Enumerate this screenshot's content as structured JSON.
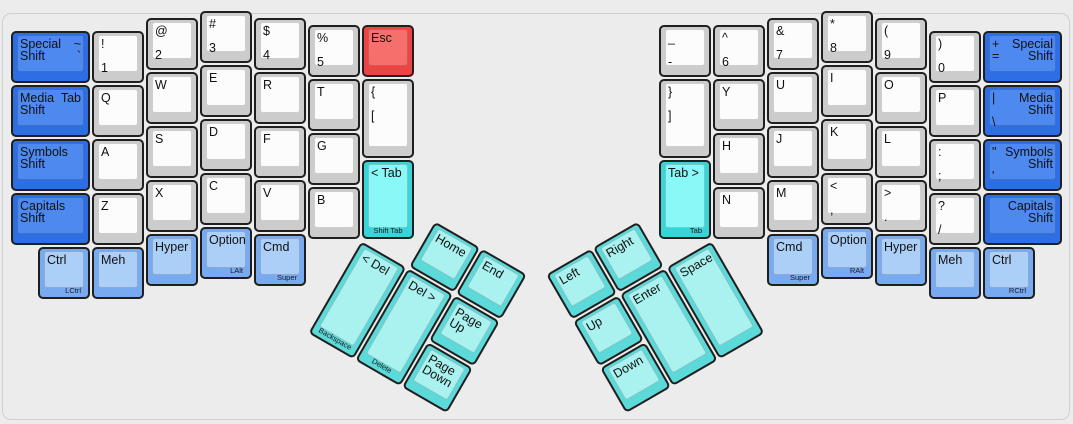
{
  "board": {
    "background": "#ececec",
    "unit_px": 54,
    "colors": {
      "gray": {
        "base": "#cccccc",
        "top": "#fcfcfc"
      },
      "blue": {
        "base": "#2d6ee4",
        "top": "#4d89ee"
      },
      "mod": {
        "base": "#78aaf2",
        "top": "#accff8"
      },
      "tab": {
        "base": "#38d4d8",
        "top": "#8bf8f8"
      },
      "thumb": {
        "base": "#5cd9d9",
        "top": "#a9f2f0"
      },
      "red": {
        "base": "#ee4343",
        "top": "#f5706c"
      }
    }
  },
  "keys": [
    {
      "n": "special-shift-left",
      "g": "M",
      "x": 0,
      "y": 0.375,
      "w": 1.5,
      "c": "blue",
      "tl": [
        "Special Shift"
      ],
      "tr": [
        "~",
        "`"
      ]
    },
    {
      "n": "media-shift-left",
      "g": "M",
      "x": 0,
      "y": 1.375,
      "w": 1.5,
      "c": "blue",
      "tl": [
        "Media Shift"
      ],
      "tr": [
        "Tab"
      ]
    },
    {
      "n": "symbols-shift-left",
      "g": "M",
      "x": 0,
      "y": 2.375,
      "w": 1.5,
      "c": "blue",
      "tl": [
        "Symbols Shift"
      ]
    },
    {
      "n": "capitals-shift-left",
      "g": "M",
      "x": 0,
      "y": 3.375,
      "w": 1.5,
      "c": "blue",
      "tl": [
        "Capitals Shift"
      ]
    },
    {
      "n": "1",
      "g": "M",
      "x": 1.5,
      "y": 0.375,
      "tl": [
        "!",
        "",
        "1"
      ]
    },
    {
      "n": "q",
      "g": "M",
      "x": 1.5,
      "y": 1.375,
      "tl": [
        "Q"
      ]
    },
    {
      "n": "a",
      "g": "M",
      "x": 1.5,
      "y": 2.375,
      "tl": [
        "A"
      ]
    },
    {
      "n": "z",
      "g": "M",
      "x": 1.5,
      "y": 3.375,
      "tl": [
        "Z"
      ]
    },
    {
      "n": "2",
      "g": "M",
      "x": 2.5,
      "y": 0.125,
      "tl": [
        "@",
        "",
        "2"
      ]
    },
    {
      "n": "w",
      "g": "M",
      "x": 2.5,
      "y": 1.125,
      "tl": [
        "W"
      ]
    },
    {
      "n": "s",
      "g": "M",
      "x": 2.5,
      "y": 2.125,
      "tl": [
        "S"
      ]
    },
    {
      "n": "x",
      "g": "M",
      "x": 2.5,
      "y": 3.125,
      "tl": [
        "X"
      ]
    },
    {
      "n": "3",
      "g": "M",
      "x": 3.5,
      "y": 0,
      "tl": [
        "#",
        "",
        "3"
      ]
    },
    {
      "n": "e",
      "g": "M",
      "x": 3.5,
      "y": 1,
      "tl": [
        "E"
      ]
    },
    {
      "n": "d",
      "g": "M",
      "x": 3.5,
      "y": 2,
      "tl": [
        "D"
      ]
    },
    {
      "n": "c",
      "g": "M",
      "x": 3.5,
      "y": 3,
      "tl": [
        "C"
      ]
    },
    {
      "n": "4",
      "g": "M",
      "x": 4.5,
      "y": 0.125,
      "tl": [
        "$",
        "",
        "4"
      ]
    },
    {
      "n": "r",
      "g": "M",
      "x": 4.5,
      "y": 1.125,
      "tl": [
        "R"
      ]
    },
    {
      "n": "f",
      "g": "M",
      "x": 4.5,
      "y": 2.125,
      "tl": [
        "F"
      ]
    },
    {
      "n": "v",
      "g": "M",
      "x": 4.5,
      "y": 3.125,
      "tl": [
        "V"
      ]
    },
    {
      "n": "5",
      "g": "M",
      "x": 5.5,
      "y": 0.25,
      "tl": [
        "%",
        "",
        "5"
      ]
    },
    {
      "n": "t",
      "g": "M",
      "x": 5.5,
      "y": 1.25,
      "tl": [
        "T"
      ]
    },
    {
      "n": "g",
      "g": "M",
      "x": 5.5,
      "y": 2.25,
      "tl": [
        "G"
      ]
    },
    {
      "n": "b",
      "g": "M",
      "x": 5.5,
      "y": 3.25,
      "tl": [
        "B"
      ]
    },
    {
      "n": "esc",
      "g": "M",
      "x": 6.5,
      "y": 0.25,
      "c": "red",
      "tl": [
        "Esc"
      ]
    },
    {
      "n": "left-bracket",
      "g": "M",
      "x": 6.5,
      "y": 1.25,
      "h": 1.5,
      "tl": [
        "{",
        "",
        "["
      ]
    },
    {
      "n": "shift-tab",
      "g": "M",
      "x": 6.5,
      "y": 2.75,
      "h": 1.5,
      "c": "tab",
      "tl": [
        "< Tab"
      ],
      "f": "Shift Tab",
      "fa": "c"
    },
    {
      "n": "ctrl-left",
      "g": "M",
      "x": 0.5,
      "y": 4.375,
      "c": "mod",
      "tl": [
        "Ctrl"
      ],
      "f": "LCtrl"
    },
    {
      "n": "meh-left",
      "g": "M",
      "x": 1.5,
      "y": 4.375,
      "c": "mod",
      "tl": [
        "Meh"
      ]
    },
    {
      "n": "hyper-left",
      "g": "M",
      "x": 2.5,
      "y": 4.125,
      "c": "mod",
      "tl": [
        "Hyper"
      ]
    },
    {
      "n": "option-left",
      "g": "M",
      "x": 3.5,
      "y": 4,
      "c": "mod",
      "tl": [
        "Option"
      ],
      "f": "LAlt"
    },
    {
      "n": "cmd-left",
      "g": "M",
      "x": 4.5,
      "y": 4.125,
      "c": "mod",
      "tl": [
        "Cmd"
      ],
      "f": "Super"
    },
    {
      "n": "minus",
      "g": "M",
      "x": 12,
      "y": 0.25,
      "tl": [
        "_",
        "",
        "-"
      ]
    },
    {
      "n": "right-bracket",
      "g": "M",
      "x": 12,
      "y": 1.25,
      "h": 1.5,
      "tl": [
        "}",
        "",
        "]"
      ]
    },
    {
      "n": "tab-right",
      "g": "M",
      "x": 12,
      "y": 2.75,
      "h": 1.5,
      "c": "tab",
      "tl": [
        "Tab >"
      ],
      "f": "Tab"
    },
    {
      "n": "6",
      "g": "M",
      "x": 13,
      "y": 0.25,
      "tl": [
        "^",
        "",
        "6"
      ]
    },
    {
      "n": "y",
      "g": "M",
      "x": 13,
      "y": 1.25,
      "tl": [
        "Y"
      ]
    },
    {
      "n": "h",
      "g": "M",
      "x": 13,
      "y": 2.25,
      "tl": [
        "H"
      ]
    },
    {
      "n": "n",
      "g": "M",
      "x": 13,
      "y": 3.25,
      "tl": [
        "N"
      ]
    },
    {
      "n": "7",
      "g": "M",
      "x": 14,
      "y": 0.125,
      "tl": [
        "&",
        "",
        "7"
      ]
    },
    {
      "n": "u",
      "g": "M",
      "x": 14,
      "y": 1.125,
      "tl": [
        "U"
      ]
    },
    {
      "n": "j",
      "g": "M",
      "x": 14,
      "y": 2.125,
      "tl": [
        "J"
      ]
    },
    {
      "n": "m",
      "g": "M",
      "x": 14,
      "y": 3.125,
      "tl": [
        "M"
      ]
    },
    {
      "n": "8",
      "g": "M",
      "x": 15,
      "y": 0,
      "tl": [
        "*",
        "",
        "8"
      ]
    },
    {
      "n": "i",
      "g": "M",
      "x": 15,
      "y": 1,
      "tl": [
        "I"
      ]
    },
    {
      "n": "k",
      "g": "M",
      "x": 15,
      "y": 2,
      "tl": [
        "K"
      ]
    },
    {
      "n": "comma",
      "g": "M",
      "x": 15,
      "y": 3,
      "tl": [
        "<",
        "",
        ","
      ]
    },
    {
      "n": "9",
      "g": "M",
      "x": 16,
      "y": 0.125,
      "tl": [
        "(",
        "",
        "9"
      ]
    },
    {
      "n": "o",
      "g": "M",
      "x": 16,
      "y": 1.125,
      "tl": [
        "O"
      ]
    },
    {
      "n": "l",
      "g": "M",
      "x": 16,
      "y": 2.125,
      "tl": [
        "L"
      ]
    },
    {
      "n": "period",
      "g": "M",
      "x": 16,
      "y": 3.125,
      "tl": [
        ">",
        "",
        "."
      ]
    },
    {
      "n": "0",
      "g": "M",
      "x": 17,
      "y": 0.375,
      "tl": [
        ")",
        "",
        "0"
      ]
    },
    {
      "n": "p",
      "g": "M",
      "x": 17,
      "y": 1.375,
      "tl": [
        "P"
      ]
    },
    {
      "n": "semicolon",
      "g": "M",
      "x": 17,
      "y": 2.375,
      "tl": [
        ":",
        "",
        ";"
      ]
    },
    {
      "n": "slash",
      "g": "M",
      "x": 17,
      "y": 3.375,
      "tl": [
        "?",
        "",
        "/"
      ]
    },
    {
      "n": "special-shift-right",
      "g": "M",
      "x": 18,
      "y": 0.375,
      "w": 1.5,
      "c": "blue",
      "tl": [
        "+",
        "="
      ],
      "tr": [
        "Special Shift"
      ]
    },
    {
      "n": "media-shift-right",
      "g": "M",
      "x": 18,
      "y": 1.375,
      "w": 1.5,
      "c": "blue",
      "tl": [
        "|",
        "",
        "\\"
      ],
      "tr": [
        "Media Shift"
      ]
    },
    {
      "n": "symbols-shift-right",
      "g": "M",
      "x": 18,
      "y": 2.375,
      "w": 1.5,
      "c": "blue",
      "tl": [
        "\"",
        "",
        "'"
      ],
      "tr": [
        "Symbols Shift"
      ]
    },
    {
      "n": "capitals-shift-right",
      "g": "M",
      "x": 18,
      "y": 3.375,
      "w": 1.5,
      "c": "blue",
      "tr": [
        "Capitals Shift"
      ]
    },
    {
      "n": "cmd-right",
      "g": "M",
      "x": 14,
      "y": 4.125,
      "c": "mod",
      "tl": [
        "Cmd"
      ],
      "f": "Super"
    },
    {
      "n": "option-right",
      "g": "M",
      "x": 15,
      "y": 4,
      "c": "mod",
      "tl": [
        "Option"
      ],
      "f": "RAlt"
    },
    {
      "n": "hyper-right",
      "g": "M",
      "x": 16,
      "y": 4.125,
      "c": "mod",
      "tl": [
        "Hyper"
      ]
    },
    {
      "n": "meh-right",
      "g": "M",
      "x": 17,
      "y": 4.375,
      "c": "mod",
      "tl": [
        "Meh"
      ]
    },
    {
      "n": "ctrl-right",
      "g": "M",
      "x": 18,
      "y": 4.375,
      "c": "mod",
      "tl": [
        "Ctrl"
      ],
      "f": "RCtrl"
    },
    {
      "n": "home",
      "g": "TL",
      "x": 1,
      "y": -1,
      "c": "thumb",
      "tl": [
        "Home"
      ]
    },
    {
      "n": "end",
      "g": "TL",
      "x": 2,
      "y": -1,
      "c": "thumb",
      "tl": [
        "End"
      ]
    },
    {
      "n": "backspace",
      "g": "TL",
      "x": 0,
      "y": 0,
      "h": 2,
      "c": "thumb",
      "tl": [
        "< Del"
      ],
      "f": "Backspace",
      "fa": "c"
    },
    {
      "n": "delete",
      "g": "TL",
      "x": 1,
      "y": 0,
      "h": 2,
      "c": "thumb",
      "tl": [
        "Del >"
      ],
      "f": "Delete",
      "fa": "c"
    },
    {
      "n": "page-up",
      "g": "TL",
      "x": 2,
      "y": 0,
      "c": "thumb",
      "tl": [
        "Page Up"
      ]
    },
    {
      "n": "page-down",
      "g": "TL",
      "x": 2,
      "y": 1,
      "c": "thumb",
      "tl": [
        "Page Down"
      ]
    },
    {
      "n": "left-arrow",
      "g": "TR",
      "x": -3,
      "y": -1,
      "c": "thumb",
      "tl": [
        "Left"
      ]
    },
    {
      "n": "right-arrow",
      "g": "TR",
      "x": -2,
      "y": -1,
      "c": "thumb",
      "tl": [
        "Right"
      ]
    },
    {
      "n": "up-arrow",
      "g": "TR",
      "x": -3,
      "y": 0,
      "c": "thumb",
      "tl": [
        "Up"
      ]
    },
    {
      "n": "enter",
      "g": "TR",
      "x": -2,
      "y": 0,
      "h": 2,
      "c": "thumb",
      "tl": [
        "Enter"
      ]
    },
    {
      "n": "space",
      "g": "TR",
      "x": -1,
      "y": 0,
      "h": 2,
      "c": "thumb",
      "tl": [
        "Space"
      ]
    },
    {
      "n": "down-arrow",
      "g": "TR",
      "x": -3,
      "y": 1,
      "c": "thumb",
      "tl": [
        "Down"
      ]
    }
  ]
}
